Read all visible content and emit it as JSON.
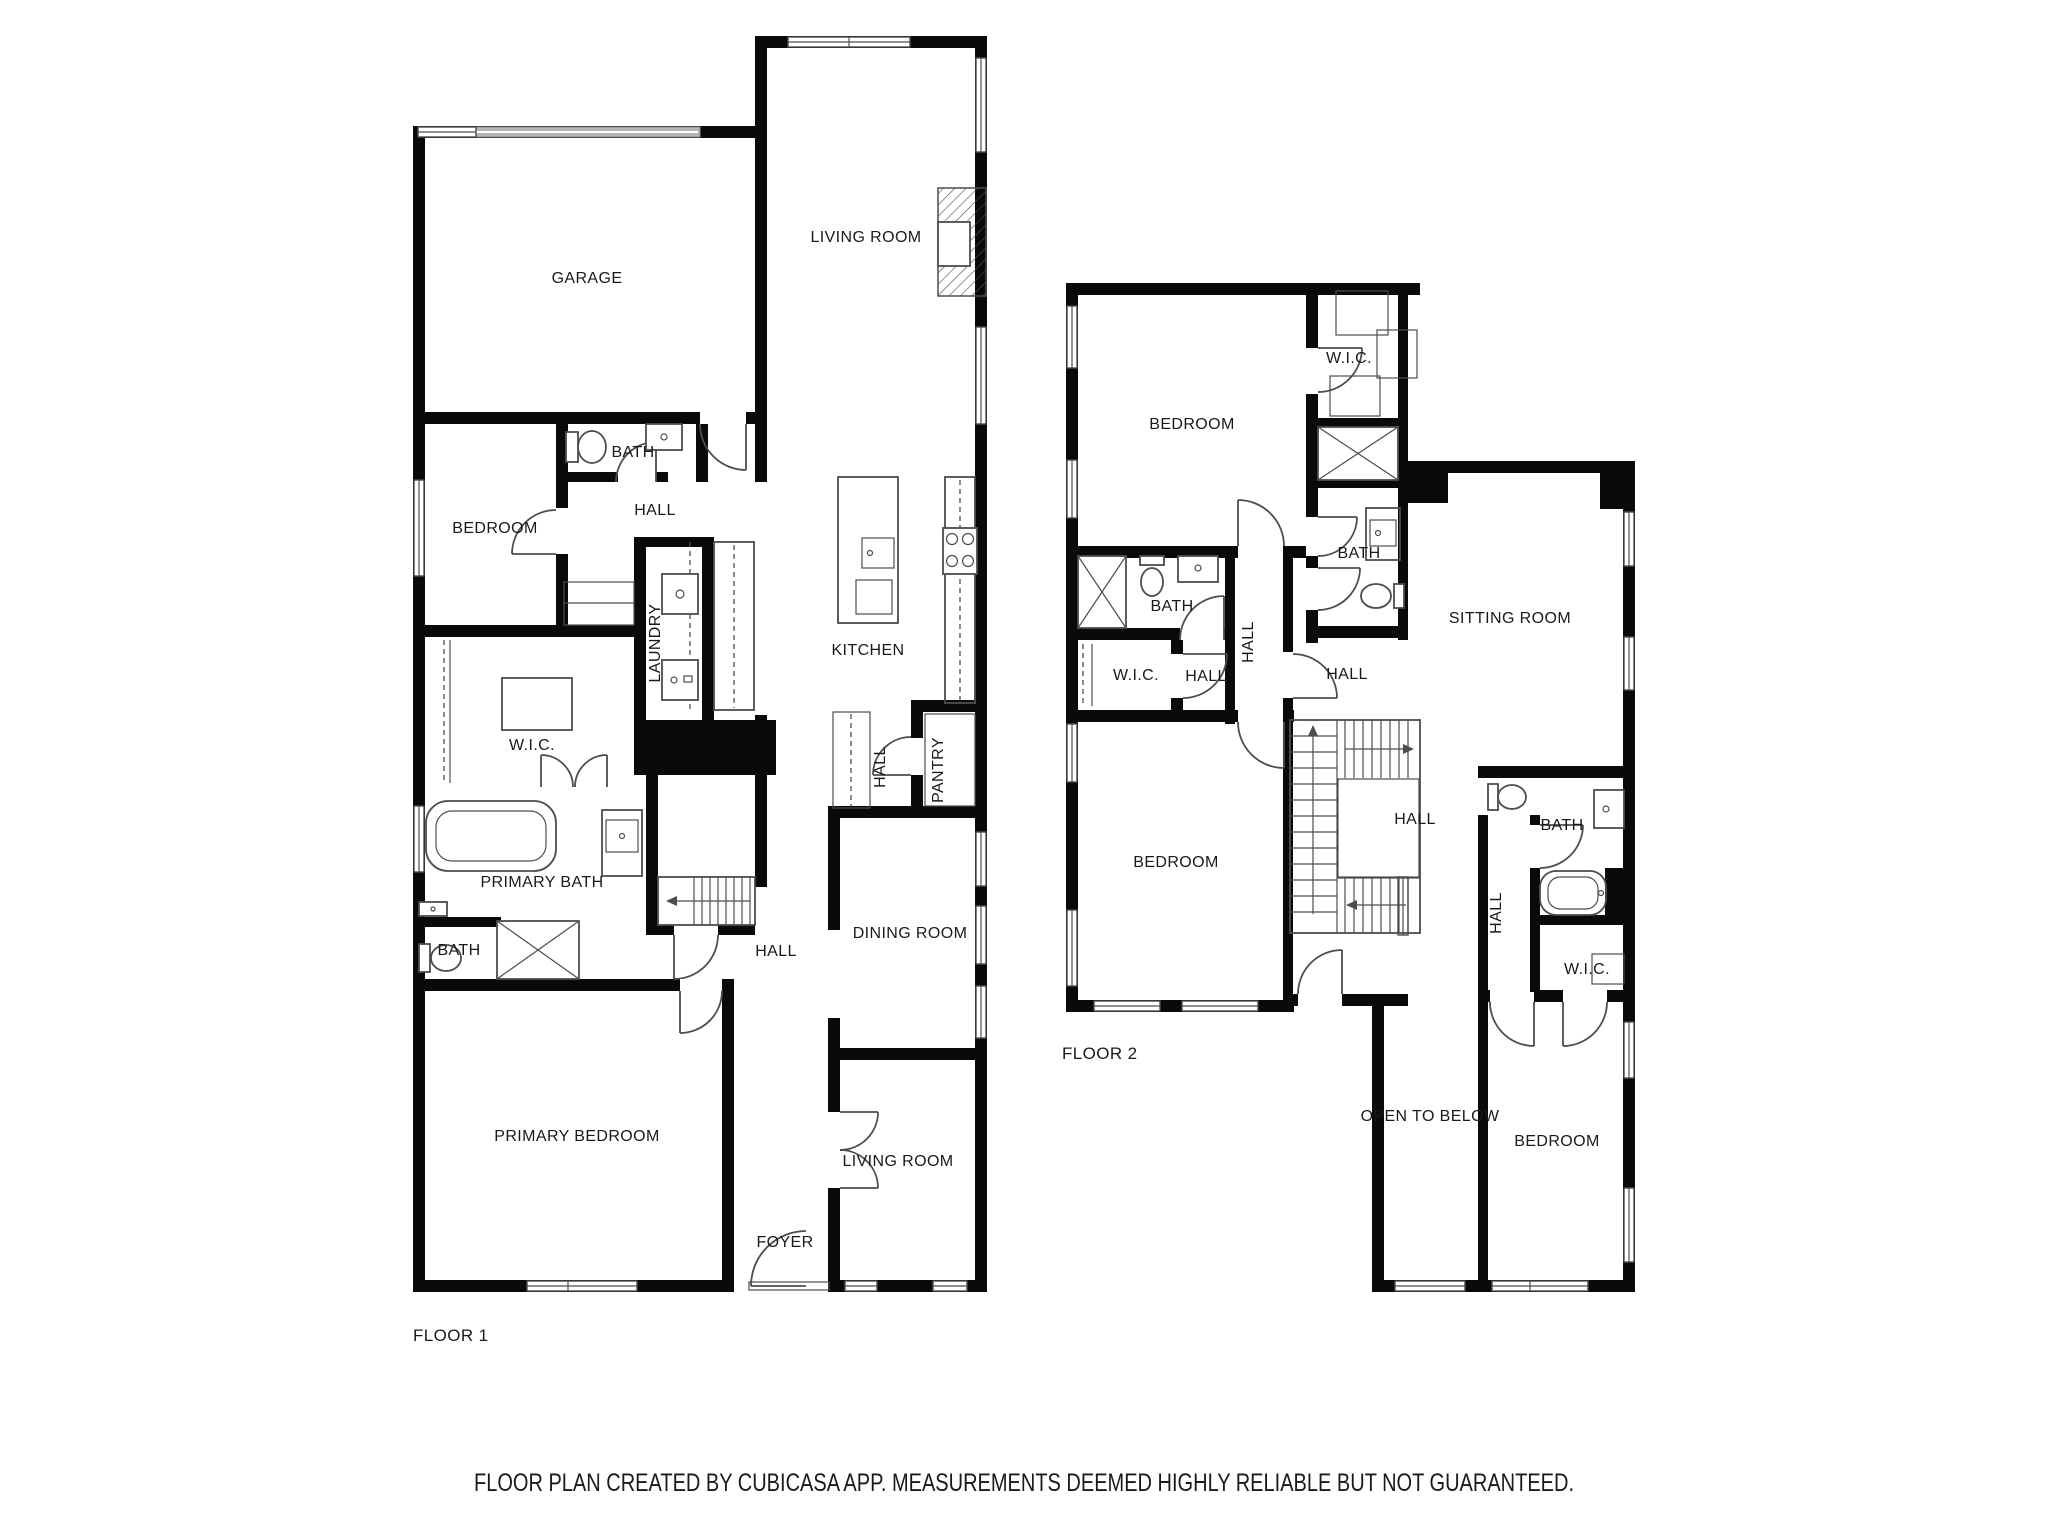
{
  "caption": "FLOOR PLAN CREATED BY CUBICASA APP. MEASUREMENTS DEEMED HIGHLY RELIABLE BUT NOT GUARANTEED.",
  "colors": {
    "wall": "#0a0a0a",
    "line": "#4d4d4d",
    "text": "#1a1a1a",
    "bg": "#ffffff",
    "door_band": "#b5b5b5"
  },
  "floor1": {
    "floor_label": "FLOOR 1",
    "rooms": {
      "garage": "GARAGE",
      "living_room": "LIVING ROOM",
      "bath": "BATH",
      "hall_upper": "HALL",
      "bedroom": "BEDROOM",
      "laundry": "LAUNDRY",
      "kitchen": "KITCHEN",
      "wic": "W.I.C.",
      "hall_mid": "HALL",
      "pantry": "PANTRY",
      "primary_bath": "PRIMARY BATH",
      "bath_small": "BATH",
      "hall_lower": "HALL",
      "dining_room": "DINING ROOM",
      "living_room_lower": "LIVING ROOM",
      "primary_bedroom": "PRIMARY BEDROOM",
      "foyer": "FOYER"
    }
  },
  "floor2": {
    "floor_label": "FLOOR 2",
    "rooms": {
      "bedroom_top": "BEDROOM",
      "wic_top": "W.I.C.",
      "bath_top": "BATH",
      "sitting_room": "SITTING ROOM",
      "bath_mid": "BATH",
      "wic_mid": "W.I.C.",
      "hall_vestibule": "HALL",
      "hall_corridor": "HALL",
      "hall_center": "HALL",
      "hall_east": "HALL",
      "bedroom_left": "BEDROOM",
      "hall_south": "HALL",
      "bath_right": "BATH",
      "wic_right": "W.I.C.",
      "open_to_below": "OPEN TO BELOW",
      "bedroom_bottom": "BEDROOM"
    }
  }
}
